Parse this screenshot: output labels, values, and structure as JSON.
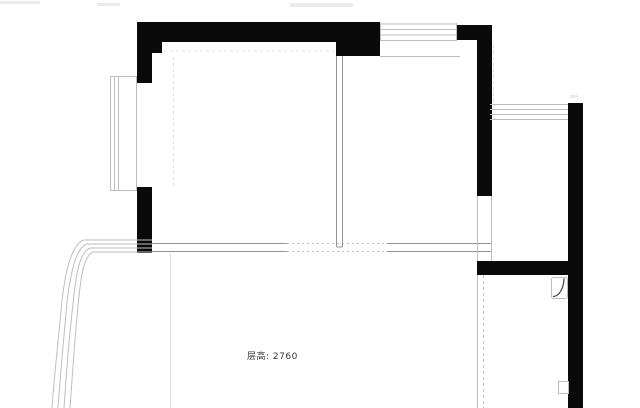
{
  "canvas": {
    "width": 640,
    "height": 408,
    "background": "#ffffff"
  },
  "label": {
    "text": "层高: 2760"
  },
  "colors": {
    "wall": "#0a0a0a",
    "medium": "#8e939c",
    "light": "#b9bec6",
    "faint": "#dcdfe3",
    "smudge": "#e9ebee",
    "dark": "#4a4a50",
    "text": "#36363b",
    "background": "#ffffff"
  },
  "plan": {
    "walls": [
      {
        "name": "wall-left-upper",
        "x": 137,
        "y": 22,
        "w": 15,
        "h": 61
      },
      {
        "name": "wall-top-left-corner",
        "x": 152,
        "y": 22,
        "w": 10,
        "h": 31
      },
      {
        "name": "wall-top",
        "x": 137,
        "y": 22,
        "w": 199,
        "h": 20
      },
      {
        "name": "wall-top-pier",
        "x": 336,
        "y": 22,
        "w": 44,
        "h": 34
      },
      {
        "name": "wall-top-right-cap",
        "x": 457,
        "y": 25,
        "w": 35,
        "h": 15
      },
      {
        "name": "wall-middle-vertical",
        "x": 477,
        "y": 25,
        "w": 15,
        "h": 171
      },
      {
        "name": "wall-right",
        "x": 568,
        "y": 103,
        "w": 15,
        "h": 305
      },
      {
        "name": "wall-kitchen-top",
        "x": 477,
        "y": 261,
        "w": 106,
        "h": 14
      },
      {
        "name": "wall-left-lower",
        "x": 137,
        "y": 187,
        "w": 15,
        "h": 66
      }
    ],
    "rects": [
      {
        "name": "window-left-bay-frame",
        "x": 110.5,
        "y": 76.5,
        "w": 26,
        "h": 114,
        "tone": "light"
      },
      {
        "name": "flue-symbol-box",
        "x": 551.5,
        "y": 277.5,
        "w": 16,
        "h": 21,
        "rx": 2,
        "tone": "light"
      },
      {
        "name": "pipe-box",
        "x": 558.5,
        "y": 381.5,
        "w": 10,
        "h": 12,
        "tone": "light"
      }
    ],
    "lines": [
      {
        "name": "window-top-glass-line",
        "x1": 380,
        "y1": 24,
        "x2": 457,
        "y2": 24,
        "tone": "light"
      },
      {
        "name": "window-top-glass-line",
        "x1": 380,
        "y1": 29.5,
        "x2": 457,
        "y2": 29.5,
        "tone": "light"
      },
      {
        "name": "window-top-glass-line",
        "x1": 380,
        "y1": 35,
        "x2": 457,
        "y2": 35,
        "tone": "light"
      },
      {
        "name": "window-top-glass-line",
        "x1": 380,
        "y1": 40.5,
        "x2": 457,
        "y2": 40.5,
        "tone": "light"
      },
      {
        "name": "window-top-end-cap",
        "x1": 380.5,
        "y1": 23,
        "x2": 380.5,
        "y2": 41,
        "tone": "light"
      },
      {
        "name": "window-top-end-cap",
        "x1": 456.5,
        "y1": 23,
        "x2": 456.5,
        "y2": 41,
        "tone": "light"
      },
      {
        "name": "window-top-sill-line",
        "x1": 380,
        "y1": 56.5,
        "x2": 460,
        "y2": 56.5,
        "tone": "light"
      },
      {
        "name": "window-right-glass-line",
        "x1": 490,
        "y1": 104.5,
        "x2": 568,
        "y2": 104.5,
        "tone": "light"
      },
      {
        "name": "window-right-glass-line",
        "x1": 490,
        "y1": 109.5,
        "x2": 568,
        "y2": 109.5,
        "tone": "light"
      },
      {
        "name": "window-right-glass-line",
        "x1": 490,
        "y1": 114.5,
        "x2": 568,
        "y2": 114.5,
        "tone": "light"
      },
      {
        "name": "window-right-glass-line",
        "x1": 490,
        "y1": 119.5,
        "x2": 568,
        "y2": 119.5,
        "tone": "light"
      },
      {
        "name": "window-left-glass-line",
        "x1": 114.5,
        "y1": 77,
        "x2": 114.5,
        "y2": 190,
        "tone": "light"
      },
      {
        "name": "window-left-glass-line",
        "x1": 118.5,
        "y1": 77,
        "x2": 118.5,
        "y2": 190,
        "tone": "light"
      },
      {
        "name": "interior-wall-edge",
        "x1": 336.5,
        "y1": 56,
        "x2": 336.5,
        "y2": 247,
        "tone": "medium"
      },
      {
        "name": "interior-wall-edge",
        "x1": 342.5,
        "y1": 56,
        "x2": 342.5,
        "y2": 247,
        "tone": "medium"
      },
      {
        "name": "interior-wall-cap",
        "x1": 336.5,
        "y1": 247,
        "x2": 342.5,
        "y2": 247,
        "tone": "medium"
      },
      {
        "name": "interior-wall-edge",
        "x1": 152,
        "y1": 243.5,
        "x2": 287,
        "y2": 243.5,
        "tone": "medium"
      },
      {
        "name": "interior-wall-edge",
        "x1": 152,
        "y1": 251.5,
        "x2": 287,
        "y2": 251.5,
        "tone": "medium"
      },
      {
        "name": "opening-dashed-line",
        "x1": 287,
        "y1": 243.5,
        "x2": 387,
        "y2": 243.5,
        "tone": "light",
        "dash": "2 3"
      },
      {
        "name": "opening-dashed-line",
        "x1": 287,
        "y1": 251.5,
        "x2": 387,
        "y2": 251.5,
        "tone": "light",
        "dash": "2 3"
      },
      {
        "name": "interior-wall-edge",
        "x1": 387,
        "y1": 243.5,
        "x2": 492,
        "y2": 243.5,
        "tone": "medium"
      },
      {
        "name": "interior-wall-edge",
        "x1": 387,
        "y1": 251.5,
        "x2": 492,
        "y2": 251.5,
        "tone": "medium"
      },
      {
        "name": "doorway-edge",
        "x1": 477.5,
        "y1": 196,
        "x2": 477.5,
        "y2": 261,
        "tone": "light"
      },
      {
        "name": "doorway-edge",
        "x1": 491.5,
        "y1": 196,
        "x2": 491.5,
        "y2": 261,
        "tone": "light"
      },
      {
        "name": "kitchen-wall-edge",
        "x1": 477.5,
        "y1": 275,
        "x2": 477.5,
        "y2": 408,
        "tone": "light"
      },
      {
        "name": "kitchen-partition-dashed",
        "x1": 483.5,
        "y1": 275,
        "x2": 483.5,
        "y2": 408,
        "tone": "light",
        "dash": "3 3"
      },
      {
        "name": "beam-dashed-line",
        "x1": 164,
        "y1": 51,
        "x2": 334,
        "y2": 51,
        "tone": "faint",
        "dash": "3 3"
      },
      {
        "name": "curtain-dashed-line",
        "x1": 173.5,
        "y1": 57,
        "x2": 173.5,
        "y2": 188,
        "tone": "faint",
        "dash": "3 3"
      },
      {
        "name": "extension-dashed-line",
        "x1": 493.5,
        "y1": 45,
        "x2": 493.5,
        "y2": 102,
        "tone": "faint",
        "dash": "3 3"
      },
      {
        "name": "living-room-edge-line",
        "x1": 170.5,
        "y1": 253,
        "x2": 170.5,
        "y2": 408,
        "tone": "faint"
      }
    ],
    "paths": [
      {
        "name": "bay-window-curve",
        "d": "M152,240 L84,240 C72,244 66,268 62,300 C58,345 54,378 52,408",
        "tone": "light"
      },
      {
        "name": "bay-window-curve",
        "d": "M152,244 L87,244 C76,248 71,270 67,302 C63,346 60,379 58,408",
        "tone": "light"
      },
      {
        "name": "bay-window-curve",
        "d": "M152,248 L90,248 C80,252 76,272 73,304 C68,347 66,380 64,408",
        "tone": "light"
      },
      {
        "name": "bay-window-curve",
        "d": "M152,252 L93,252 C84,256 81,274 78,306 C74,348 72,381 70,408",
        "tone": "light"
      },
      {
        "name": "flue-arc",
        "d": "M553.5,296.5 C559,296 563.5,289 564,279",
        "tone": "dark",
        "w": 1.3
      }
    ],
    "smudges": [
      {
        "x": 0,
        "y": 1,
        "w": 40,
        "h": 3
      },
      {
        "x": 97,
        "y": 3,
        "w": 23,
        "h": 3
      },
      {
        "x": 290,
        "y": 3,
        "w": 63,
        "h": 4
      },
      {
        "x": 570,
        "y": 95,
        "w": 8,
        "h": 3
      }
    ]
  }
}
